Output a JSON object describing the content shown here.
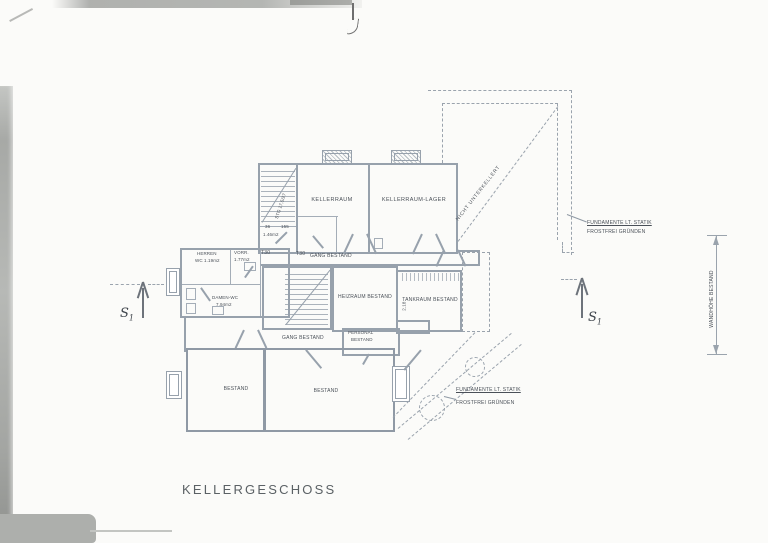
{
  "title_block": {
    "label": "KELLERGESCHOSS"
  },
  "rooms": {
    "kellerraum": "KELLERRAUM",
    "lager": "KELLERRAUM-LAGER",
    "gang_upper": "GANG BESTAND",
    "gang_lower": "GANG BESTAND",
    "herren_line1": "HERREN",
    "herren_line2": "WC 1.19m2",
    "vorr_line1": "VORR.",
    "vorr_line2": "1.77m2",
    "damen_line1": "DAMEN-WC",
    "damen_line2": "7.94m2",
    "heizraum": "HEIZRAUM BESTAND",
    "tankraum": "TANKRAUM BESTAND",
    "personal_line1": "PERSONAL",
    "personal_line2": "BESTAND",
    "bestand_left": "BESTAND",
    "bestand_right": "BESTAND"
  },
  "annotations": {
    "nicht_unterkellert": "NICHT UNTERKELLERT",
    "fund_upper_1": "FUNDAMENTE LT. STATIK",
    "fund_upper_2": "FROSTFREI GRÜNDEN",
    "fund_lower_1": "FUNDAMENTE LT. STATIK",
    "fund_lower_2": "FROSTFREI GRÜNDEN",
    "wandhoehe": "WANDHÖHE BESTAND",
    "section_letter": "S",
    "section_sub": "1"
  },
  "dims": {
    "stair_w1": "36",
    "stair_w2": "155",
    "stair_area": "1.46m2",
    "door_t30_a": "T30",
    "door_t30_b": "T30",
    "stair_note": "STG 17,5/27",
    "tank_dim": "2.18"
  },
  "colors": {
    "wall": "#97a1ac",
    "text": "#4a5058",
    "paper": "#fbfbf9"
  }
}
